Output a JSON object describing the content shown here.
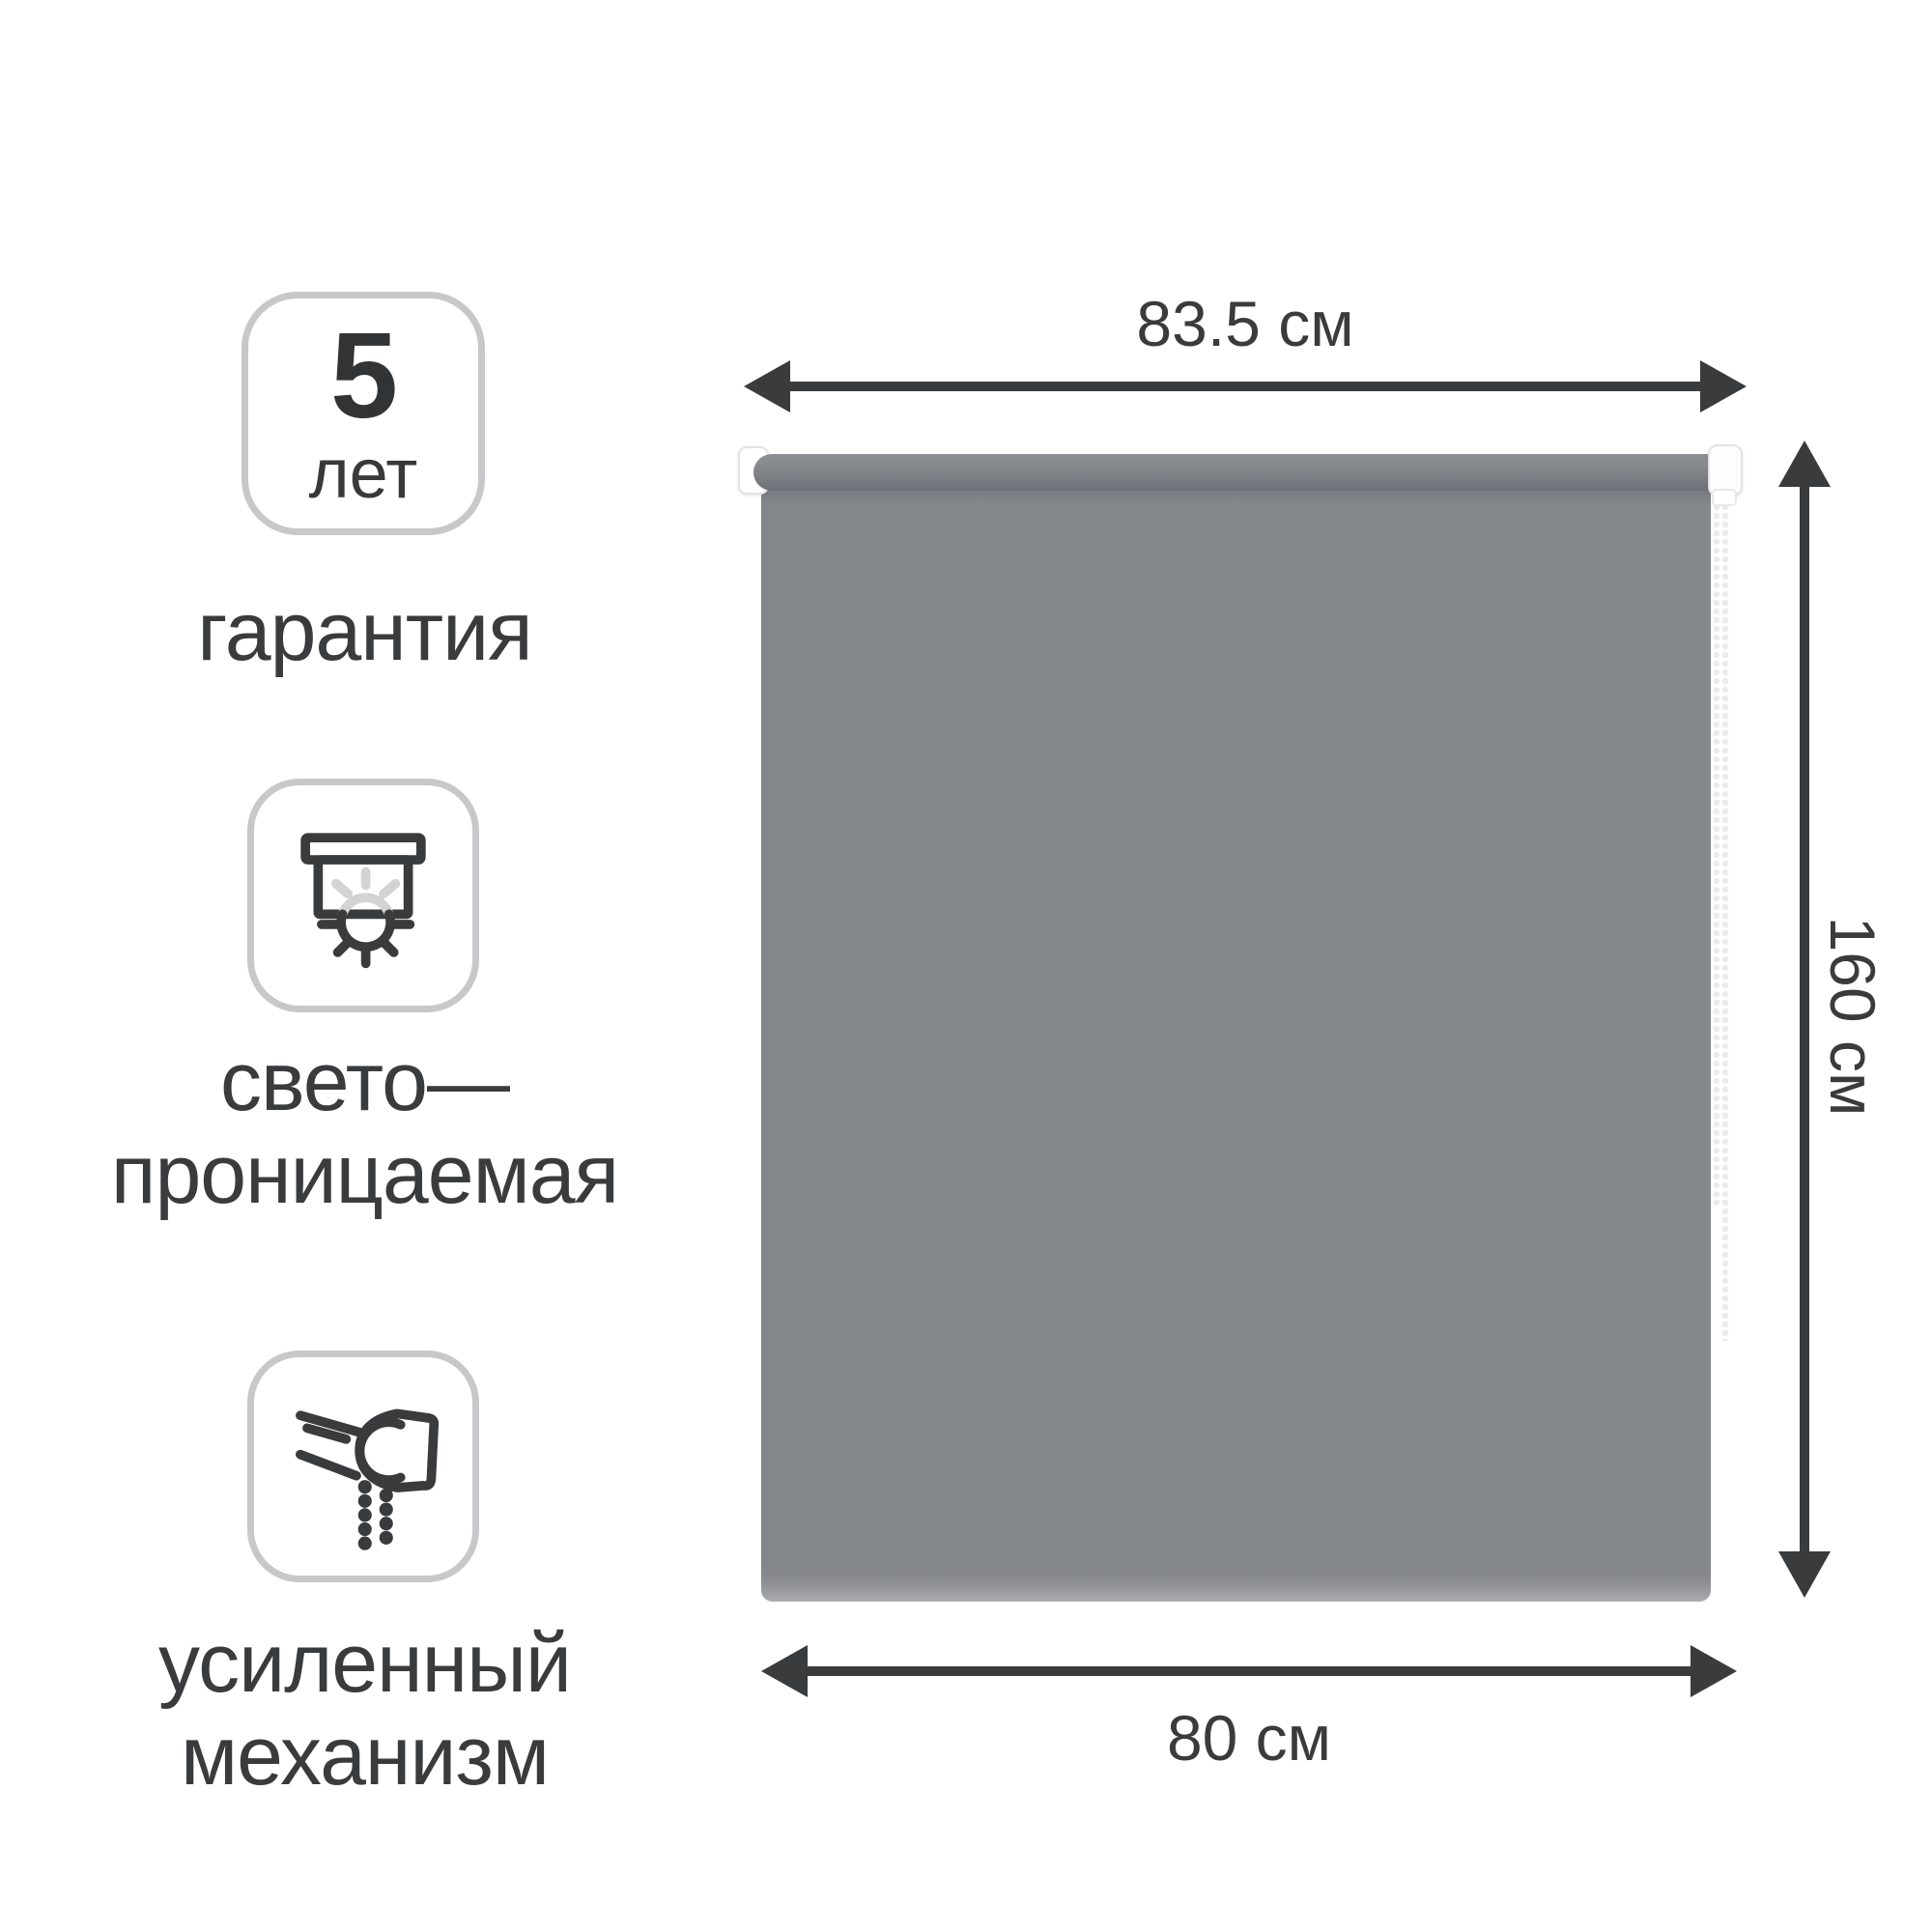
{
  "features": {
    "warranty": {
      "value": "5",
      "unit": "лет",
      "label": "гарантия"
    },
    "light": {
      "line1": "свето—",
      "line2": "проницаемая",
      "icon": "blind-sun-icon"
    },
    "mechanism": {
      "line1": "усиленный",
      "line2": "механизм",
      "icon": "roller-chain-icon"
    }
  },
  "dimensions": {
    "full_width": "83.5 см",
    "height": "160 см",
    "fabric_width": "80 см"
  },
  "product": {
    "type": "roller-blind",
    "fabric_color_name": "grey"
  },
  "colors": {
    "fabric": "#83868b",
    "dimension": "#3a3b3d",
    "badge_border": "#c8c8ca",
    "icon_dark": "#3a3b3d",
    "icon_light": "#d3d3d5"
  }
}
